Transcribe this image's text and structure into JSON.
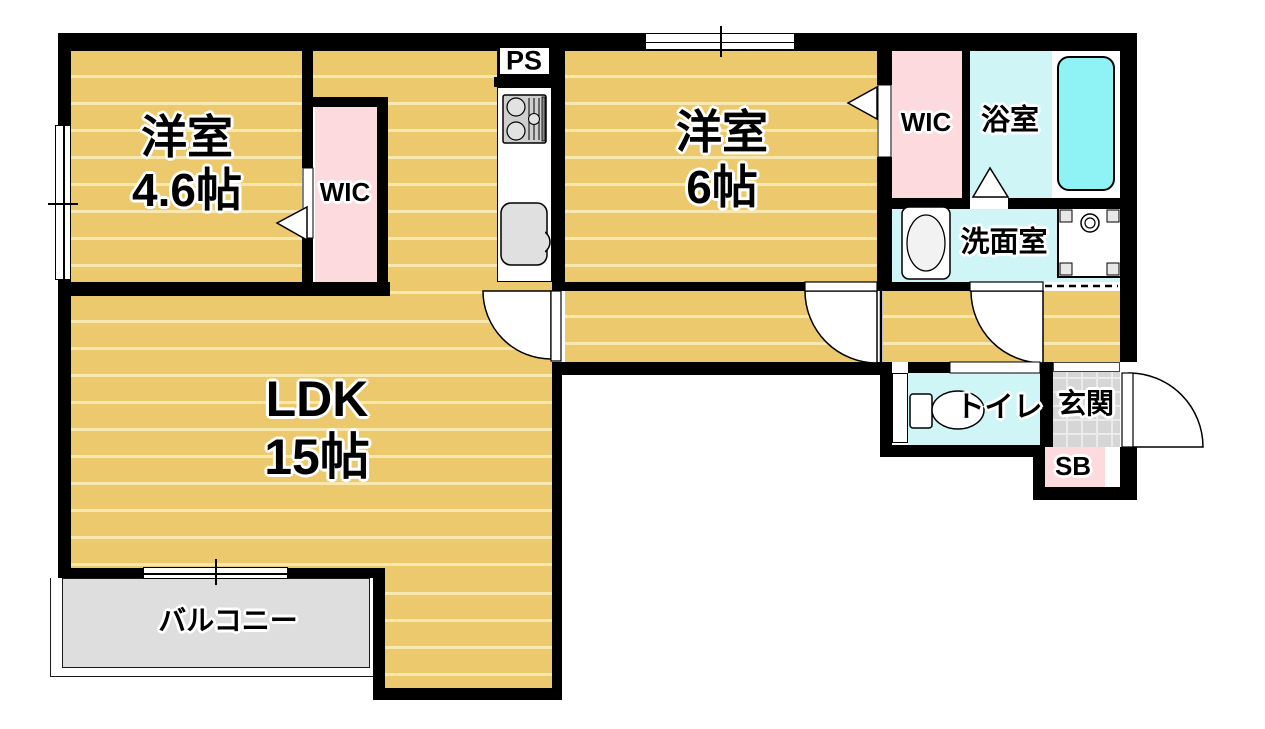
{
  "title": "apartment-floor-plan",
  "rooms": {
    "western_room_1": {
      "name": "洋室",
      "size": "4.6帖"
    },
    "western_room_2": {
      "name": "洋室",
      "size": "6帖"
    },
    "ldk": {
      "name": "LDK",
      "size": "15帖"
    },
    "wic_left": {
      "name": "WIC"
    },
    "wic_right": {
      "name": "WIC"
    },
    "pipe_space": {
      "name": "PS"
    },
    "bathroom": {
      "name": "浴室"
    },
    "washroom": {
      "name": "洗面室"
    },
    "toilet": {
      "name": "トイレ"
    },
    "entrance": {
      "name": "玄関"
    },
    "shoe_box": {
      "name": "SB"
    },
    "balcony": {
      "name": "バルコニー"
    }
  },
  "fixtures": {
    "stove": "gas-stove-icon",
    "kitchen_sink": "kitchen-sink-icon",
    "bathtub": "bathtub-icon",
    "vanity": "vanity-sink-icon",
    "washer_pan": "washing-machine-pan-icon",
    "toilet_bowl": "toilet-icon"
  },
  "colors": {
    "wood": "#ecc96d",
    "wood_stripe": "#f7e8b0",
    "closet_pink": "#fcdade",
    "wet_room_cyan": "#cff5f7",
    "bathtub_cyan": "#8ff2f5",
    "balcony_gray": "#dedede",
    "entrance_tile_gray": "#d6d6d6",
    "wall_black": "#000000"
  }
}
